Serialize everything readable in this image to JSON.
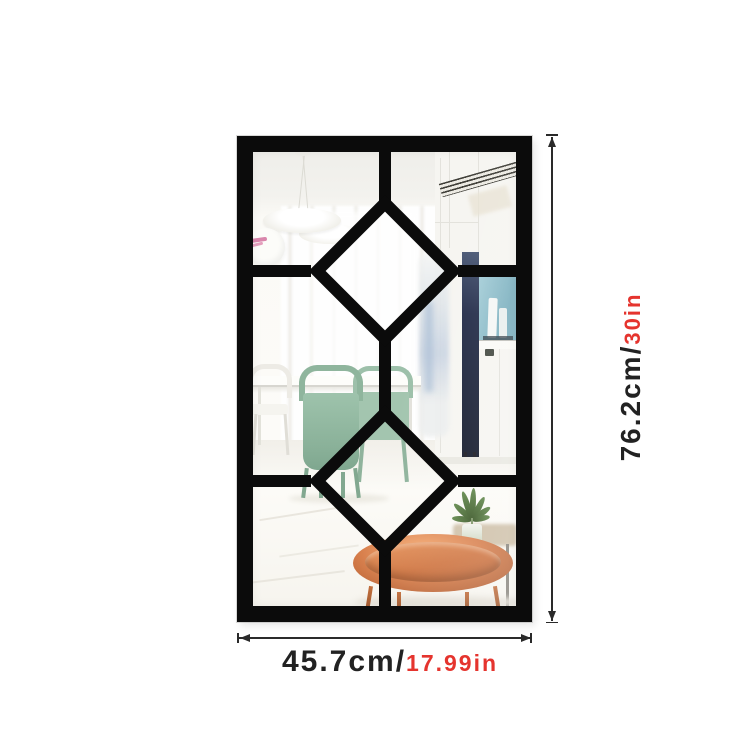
{
  "annotations": {
    "height": {
      "metric": "76.2cm/",
      "imperial": "30in"
    },
    "width": {
      "metric": "45.7cm/",
      "imperial": "17.99in"
    }
  },
  "colors": {
    "background": "#ffffff",
    "frame_black": "#0b0b0b",
    "dimension_line": "#2a2a2a",
    "label_black": "#222222",
    "label_red": "#e5342e",
    "chair_sage_green": "#93b9a1",
    "copper_table": "#d0773f",
    "niche_teal": "#8fbfcc",
    "navy_cabinet": "#1b2238"
  },
  "icons": {
    "vertical_arrows": [
      "arrow-up-icon",
      "arrow-down-icon"
    ],
    "horizontal_arrows": [
      "arrow-left-icon",
      "arrow-right-icon"
    ]
  }
}
